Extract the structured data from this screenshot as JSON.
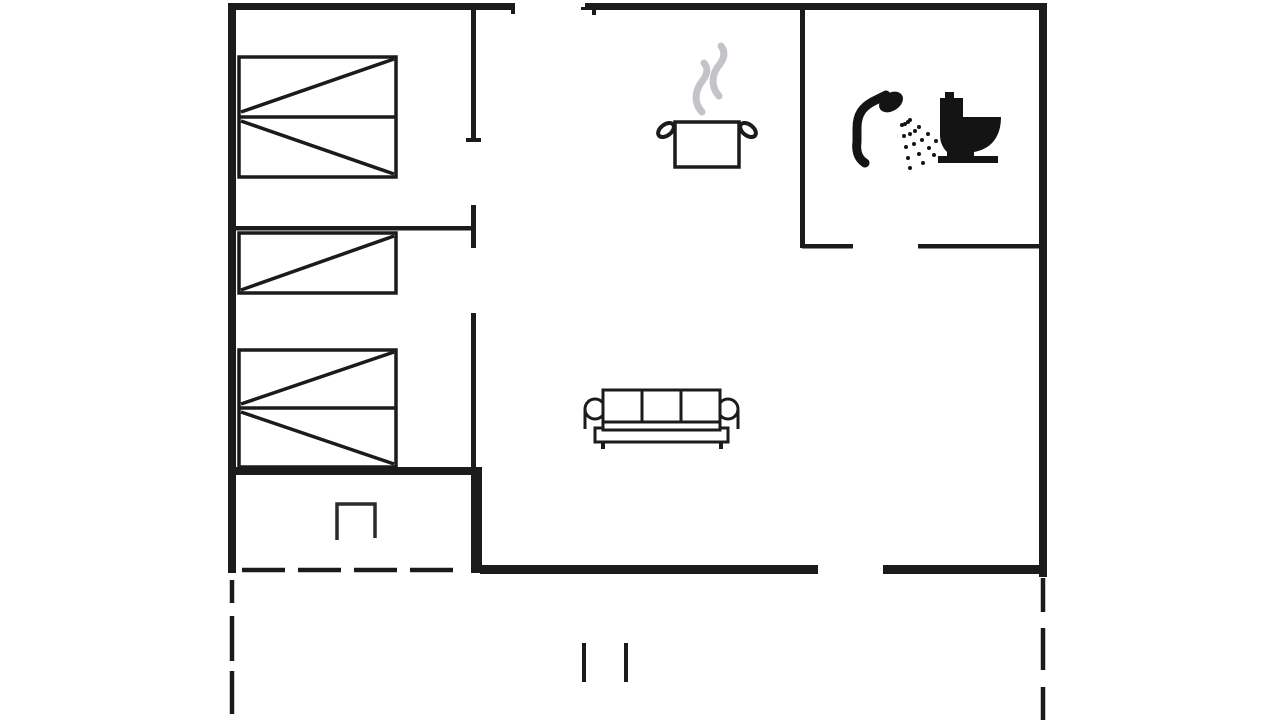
{
  "meta": {
    "kind": "floor-plan-drawing",
    "background": "#ffffff",
    "wall_color": "#1b1b1b",
    "fixture_color": "#141414",
    "steam_color": "#c4c4c8",
    "canvas": {
      "width": 1280,
      "height": 720
    }
  },
  "rooms": {
    "bedroom_top_left": "double bed",
    "bedroom_bottom_left": "single bed and double bed",
    "bathroom_top_right": "shower and toilet",
    "kitchen": "stove pot symbol",
    "living_room": "sofa",
    "porch": "open niche symbol",
    "terrace": "dashed outline with step marks"
  },
  "svg_layers": [
    {
      "group": "walls",
      "part_name": "wall",
      "attrs": {
        "fill": "#1b1b1b"
      },
      "shapes": [
        {
          "t": "rect",
          "name": "top-wall-left-segment",
          "x": 228,
          "y": 3,
          "width": 287,
          "height": 7
        },
        {
          "t": "rect",
          "name": "top-wall-right-segment",
          "x": 585,
          "y": 3,
          "width": 462,
          "height": 7
        },
        {
          "t": "rect",
          "name": "window-end-tick",
          "x": 511,
          "y": 3,
          "width": 4,
          "height": 11
        },
        {
          "t": "rect",
          "name": "window-end-tick",
          "x": 592,
          "y": 3,
          "width": 4,
          "height": 12
        },
        {
          "t": "rect",
          "name": "window-lead-line",
          "x": 581,
          "y": 7,
          "width": 12,
          "height": 3
        },
        {
          "t": "rect",
          "name": "left-exterior-wall",
          "x": 228,
          "y": 3,
          "width": 8,
          "height": 570
        },
        {
          "t": "rect",
          "name": "right-exterior-wall",
          "x": 1039,
          "y": 3,
          "width": 8,
          "height": 574
        },
        {
          "t": "rect",
          "name": "porch-north-wall",
          "x": 228,
          "y": 467,
          "width": 252,
          "height": 8
        },
        {
          "t": "rect",
          "name": "porch-east-wall",
          "x": 471,
          "y": 467,
          "width": 11,
          "height": 106
        },
        {
          "t": "rect",
          "name": "south-wall-left-segment",
          "x": 480,
          "y": 565,
          "width": 338,
          "height": 9
        },
        {
          "t": "rect",
          "name": "south-wall-right-segment",
          "x": 883,
          "y": 565,
          "width": 164,
          "height": 9
        },
        {
          "t": "rect",
          "name": "hall-wall-upper-segment",
          "x": 471,
          "y": 3,
          "width": 5,
          "height": 139
        },
        {
          "t": "rect",
          "name": "hall-wall-door-jamb",
          "x": 471,
          "y": 205,
          "width": 5,
          "height": 43
        },
        {
          "t": "rect",
          "name": "hall-wall-lower-segment",
          "x": 471,
          "y": 313,
          "width": 5,
          "height": 156
        },
        {
          "t": "rect",
          "name": "door-end-tick",
          "x": 466,
          "y": 138,
          "width": 15,
          "height": 4
        },
        {
          "t": "rect",
          "name": "bedroom-divider-wall",
          "x": 236,
          "y": 226,
          "width": 237,
          "height": 4.5
        },
        {
          "t": "rect",
          "name": "bathroom-west-wall",
          "x": 800,
          "y": 8,
          "width": 5,
          "height": 240
        },
        {
          "t": "rect",
          "name": "bathroom-south-wall-left",
          "x": 802,
          "y": 244,
          "width": 51,
          "height": 4.5
        },
        {
          "t": "rect",
          "name": "bathroom-south-wall-right",
          "x": 918,
          "y": 244,
          "width": 123,
          "height": 4.5
        }
      ]
    },
    {
      "group": "terrace-outline",
      "part_name": "terrace-line",
      "attrs": {
        "stroke": "#1b1b1b",
        "stroke-width": 4.5,
        "fill": "none"
      },
      "shapes": [
        {
          "t": "line",
          "name": "terrace-dashed-top",
          "x1": 242,
          "y1": 570,
          "x2": 456,
          "y2": 570,
          "stroke-dasharray": "43 13"
        },
        {
          "t": "line",
          "name": "terrace-dashed-left",
          "x1": 232,
          "y1": 580,
          "x2": 232,
          "y2": 720,
          "stroke-dasharray": "23 13 45 10 43"
        },
        {
          "t": "line",
          "name": "terrace-dashed-right",
          "x1": 1043,
          "y1": 578,
          "x2": 1043,
          "y2": 720,
          "stroke-dasharray": "34 16 42 17 33"
        },
        {
          "t": "line",
          "name": "terrace-step-mark",
          "x1": 584,
          "y1": 643,
          "x2": 584,
          "y2": 682,
          "stroke-width": 4
        },
        {
          "t": "line",
          "name": "terrace-step-mark",
          "x1": 626,
          "y1": 643,
          "x2": 626,
          "y2": 682,
          "stroke-width": 4
        }
      ]
    },
    {
      "group": "beds",
      "part_name": "bed-line",
      "attrs": {
        "stroke": "#1b1b1b",
        "stroke-width": 3.5,
        "fill": "none"
      },
      "shapes": [
        {
          "t": "rect",
          "name": "double-bed-top",
          "x": 239,
          "y": 57,
          "width": 157,
          "height": 120,
          "fill": "#ffffff"
        },
        {
          "t": "line",
          "name": "double-bed-top-middle",
          "x1": 239,
          "y1": 117,
          "x2": 396,
          "y2": 117
        },
        {
          "t": "line",
          "name": "double-bed-top-diagonal",
          "x1": 241,
          "y1": 112,
          "x2": 394,
          "y2": 59
        },
        {
          "t": "line",
          "name": "double-bed-top-diagonal",
          "x1": 241,
          "y1": 121,
          "x2": 394,
          "y2": 174
        },
        {
          "t": "rect",
          "name": "single-bed",
          "x": 239,
          "y": 233,
          "width": 157,
          "height": 60,
          "fill": "#ffffff"
        },
        {
          "t": "line",
          "name": "single-bed-diagonal",
          "x1": 241,
          "y1": 290,
          "x2": 394,
          "y2": 236
        },
        {
          "t": "rect",
          "name": "double-bed-bottom",
          "x": 239,
          "y": 350,
          "width": 157,
          "height": 117,
          "fill": "#ffffff"
        },
        {
          "t": "line",
          "name": "double-bed-bottom-middle",
          "x1": 239,
          "y1": 408,
          "x2": 396,
          "y2": 408
        },
        {
          "t": "line",
          "name": "double-bed-bottom-diagonal",
          "x1": 241,
          "y1": 404,
          "x2": 394,
          "y2": 352
        },
        {
          "t": "line",
          "name": "double-bed-bottom-diagonal",
          "x1": 241,
          "y1": 412,
          "x2": 394,
          "y2": 464
        }
      ]
    },
    {
      "group": "sofa",
      "part_name": "sofa-part",
      "attrs": {
        "stroke": "#1b1b1b",
        "stroke-width": 3,
        "fill": "none"
      },
      "shapes": [
        {
          "t": "circle",
          "name": "sofa-left-armrest",
          "cx": 595,
          "cy": 409,
          "r": 10,
          "fill": "#ffffff"
        },
        {
          "t": "circle",
          "name": "sofa-right-armrest",
          "cx": 728,
          "cy": 409,
          "r": 10,
          "fill": "#ffffff"
        },
        {
          "t": "line",
          "name": "sofa-arm-side",
          "x1": 585,
          "y1": 410,
          "x2": 585,
          "y2": 429
        },
        {
          "t": "line",
          "name": "sofa-arm-side",
          "x1": 738,
          "y1": 410,
          "x2": 738,
          "y2": 429
        },
        {
          "t": "rect",
          "name": "sofa-base",
          "x": 595,
          "y": 428,
          "width": 133,
          "height": 14,
          "fill": "#ffffff"
        },
        {
          "t": "rect",
          "name": "sofa-back",
          "x": 603,
          "y": 390,
          "width": 117,
          "height": 32,
          "fill": "#ffffff"
        },
        {
          "t": "rect",
          "name": "sofa-seat",
          "x": 603,
          "y": 422,
          "width": 117,
          "height": 8,
          "fill": "#ffffff"
        },
        {
          "t": "line",
          "name": "sofa-cushion-divider",
          "x1": 642,
          "y1": 390,
          "x2": 642,
          "y2": 422
        },
        {
          "t": "line",
          "name": "sofa-cushion-divider",
          "x1": 681,
          "y1": 390,
          "x2": 681,
          "y2": 422
        },
        {
          "t": "rect",
          "name": "sofa-leg",
          "x": 601,
          "y": 442,
          "width": 4,
          "height": 7,
          "fill": "#1b1b1b",
          "stroke": "none"
        },
        {
          "t": "rect",
          "name": "sofa-leg",
          "x": 719,
          "y": 442,
          "width": 4,
          "height": 7,
          "fill": "#1b1b1b",
          "stroke": "none"
        }
      ]
    },
    {
      "group": "cooking-pot-icon",
      "part_name": "pot-part",
      "attrs": {
        "stroke": "#1b1b1b",
        "stroke-width": 3.5,
        "fill": "none"
      },
      "shapes": [
        {
          "t": "ellipse",
          "name": "pot-left-handle",
          "cx": 666,
          "cy": 130,
          "rx": 9,
          "ry": 5.5,
          "transform": "rotate(-38 666 130)",
          "fill": "#ffffff",
          "stroke-width": 4
        },
        {
          "t": "ellipse",
          "name": "pot-right-handle",
          "cx": 748,
          "cy": 130,
          "rx": 9,
          "ry": 5.5,
          "transform": "rotate(38 748 130)",
          "fill": "#ffffff",
          "stroke-width": 4
        },
        {
          "t": "rect",
          "name": "pot-body",
          "x": 675,
          "y": 122,
          "width": 64,
          "height": 45,
          "fill": "#ffffff"
        },
        {
          "t": "path",
          "name": "steam-wisp",
          "d": "M 702,112 C 693,102 695,90 703,80 C 708,73 708,68 704,63",
          "stroke": "#c4c4c8",
          "stroke-width": 7,
          "stroke-linecap": "round"
        },
        {
          "t": "path",
          "name": "steam-wisp",
          "d": "M 719,96 C 710,86 712,73 720,64 C 725,57 725,51 721,46",
          "stroke": "#c4c4c8",
          "stroke-width": 7,
          "stroke-linecap": "round"
        }
      ]
    },
    {
      "group": "shower-icon",
      "part_name": "shower-part",
      "attrs": {
        "fill": "#141414"
      },
      "shapes": [
        {
          "t": "path",
          "name": "shower-hose",
          "d": "M 865,163 C 857,158 856,149 857,142 L 857,128 C 857,114 863,107 872,102 L 886,95",
          "fill": "none",
          "stroke": "#141414",
          "stroke-width": 9,
          "stroke-linecap": "round"
        },
        {
          "t": "ellipse",
          "name": "shower-head",
          "cx": 891,
          "cy": 102,
          "rx": 13,
          "ry": 9,
          "transform": "rotate(-33 891 102)"
        },
        {
          "t": "circle",
          "name": "spray-dot",
          "cx": 902,
          "cy": 125,
          "r": 2
        },
        {
          "t": "circle",
          "name": "spray-dot",
          "cx": 904,
          "cy": 136,
          "r": 2
        },
        {
          "t": "circle",
          "name": "spray-dot",
          "cx": 906,
          "cy": 147,
          "r": 2
        },
        {
          "t": "circle",
          "name": "spray-dot",
          "cx": 908,
          "cy": 158,
          "r": 2
        },
        {
          "t": "circle",
          "name": "spray-dot",
          "cx": 910,
          "cy": 168,
          "r": 2
        },
        {
          "t": "circle",
          "name": "spray-dot",
          "cx": 905,
          "cy": 124,
          "r": 2
        },
        {
          "t": "circle",
          "name": "spray-dot",
          "cx": 910,
          "cy": 134,
          "r": 2
        },
        {
          "t": "circle",
          "name": "spray-dot",
          "cx": 914,
          "cy": 144,
          "r": 2
        },
        {
          "t": "circle",
          "name": "spray-dot",
          "cx": 919,
          "cy": 154,
          "r": 2
        },
        {
          "t": "circle",
          "name": "spray-dot",
          "cx": 923,
          "cy": 163,
          "r": 2
        },
        {
          "t": "circle",
          "name": "spray-dot",
          "cx": 908,
          "cy": 122,
          "r": 2
        },
        {
          "t": "circle",
          "name": "spray-dot",
          "cx": 915,
          "cy": 131,
          "r": 2
        },
        {
          "t": "circle",
          "name": "spray-dot",
          "cx": 922,
          "cy": 140,
          "r": 2
        },
        {
          "t": "circle",
          "name": "spray-dot",
          "cx": 929,
          "cy": 148,
          "r": 2
        },
        {
          "t": "circle",
          "name": "spray-dot",
          "cx": 934,
          "cy": 155,
          "r": 2
        },
        {
          "t": "circle",
          "name": "spray-dot",
          "cx": 910,
          "cy": 120,
          "r": 2
        },
        {
          "t": "circle",
          "name": "spray-dot",
          "cx": 919,
          "cy": 127,
          "r": 2
        },
        {
          "t": "circle",
          "name": "spray-dot",
          "cx": 928,
          "cy": 134,
          "r": 2
        },
        {
          "t": "circle",
          "name": "spray-dot",
          "cx": 936,
          "cy": 141,
          "r": 2
        }
      ]
    },
    {
      "group": "toilet-icon",
      "part_name": "toilet-part",
      "attrs": {
        "fill": "#141414"
      },
      "shapes": [
        {
          "t": "path",
          "name": "toilet-silhouette",
          "d": "M 945,92 L 954,92 L 954,98 L 963,98 L 963,117 L 1001,117 C 1001,137 991,149 974,152 L 974,156 L 998,156 L 998,163 L 938,163 L 938,156 L 947,156 L 947,152 C 942,147 940,141 940,135 L 940,98 L 945,98 Z"
        }
      ]
    },
    {
      "group": "porch-symbol",
      "part_name": "porch-part",
      "attrs": {
        "stroke": "#2b2b2b",
        "stroke-width": 3.5,
        "fill": "none"
      },
      "shapes": [
        {
          "t": "path",
          "name": "porch-niche",
          "d": "M 337,540 L 337,504 L 375,504 L 375,538"
        }
      ]
    }
  ]
}
